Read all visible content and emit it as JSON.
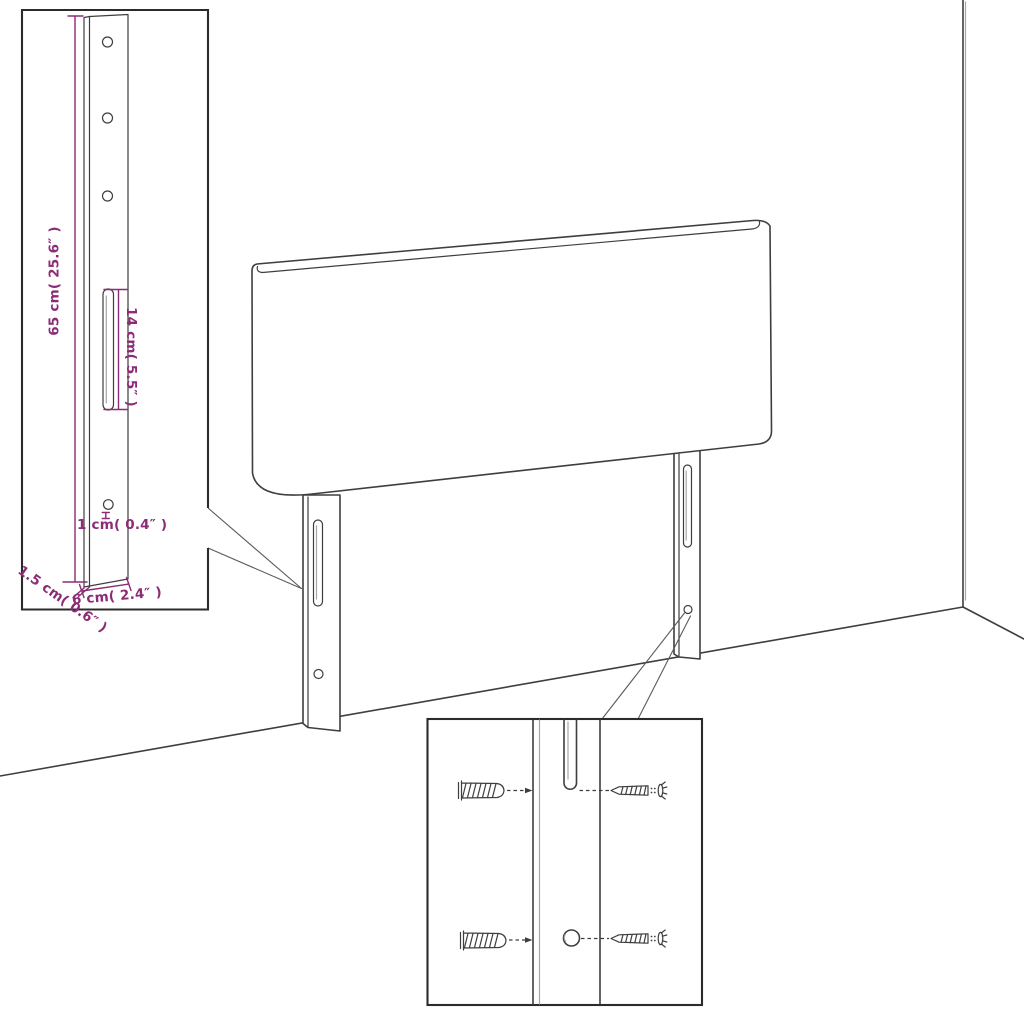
{
  "labels": {
    "height": "65 cm( 25.6″ )",
    "slot_length": "14 cm( 5.5″ )",
    "hole_diameter": "1 cm( 0.4″ )",
    "panel_thickness": "1.5 cm( 0.6″ )",
    "leg_depth": "6 cm( 2.4″ )"
  },
  "colors": {
    "dimension": "#8C2B76",
    "line": "#3E3E3E",
    "line_light": "#A6A6A6",
    "border": "#2B2B2B",
    "background": "#FFFFFF"
  }
}
